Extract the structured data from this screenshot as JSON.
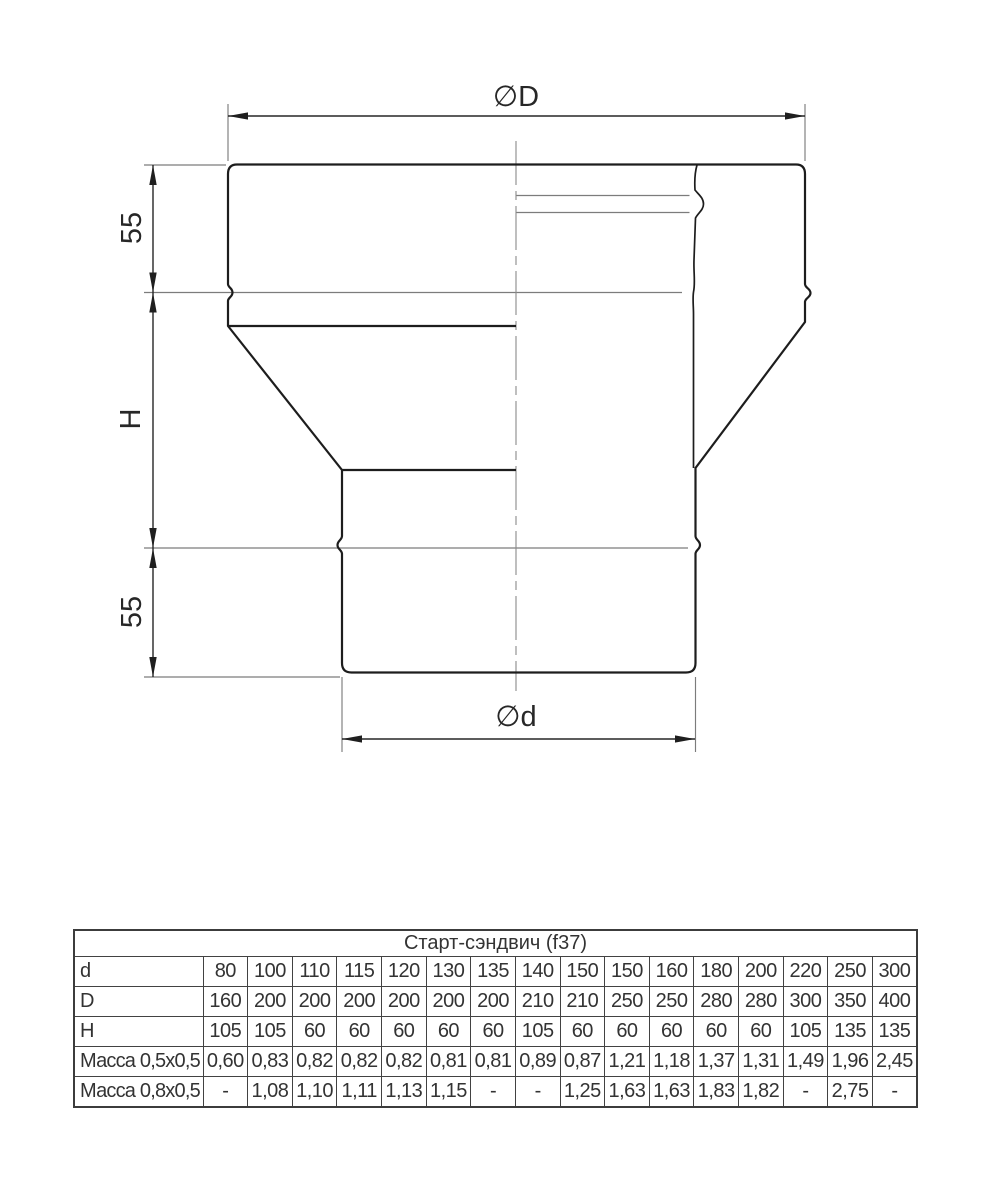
{
  "drawing": {
    "labels": {
      "diameter_top": "∅D",
      "diameter_bottom": "∅d",
      "height_top": "55",
      "height_middle": "H",
      "height_bottom": "55"
    }
  },
  "table": {
    "title": "Старт-сэндвич (f37)",
    "rows": [
      {
        "label": "d",
        "values": [
          "80",
          "100",
          "110",
          "115",
          "120",
          "130",
          "135",
          "140",
          "150",
          "150",
          "160",
          "180",
          "200",
          "220",
          "250",
          "300"
        ]
      },
      {
        "label": "D",
        "values": [
          "160",
          "200",
          "200",
          "200",
          "200",
          "200",
          "200",
          "210",
          "210",
          "250",
          "250",
          "280",
          "280",
          "300",
          "350",
          "400"
        ]
      },
      {
        "label": "H",
        "values": [
          "105",
          "105",
          "60",
          "60",
          "60",
          "60",
          "60",
          "105",
          "60",
          "60",
          "60",
          "60",
          "60",
          "105",
          "135",
          "135"
        ]
      },
      {
        "label": "Масса 0,5x0,5",
        "values": [
          "0,60",
          "0,83",
          "0,82",
          "0,82",
          "0,82",
          "0,81",
          "0,81",
          "0,89",
          "0,87",
          "1,21",
          "1,18",
          "1,37",
          "1,31",
          "1,49",
          "1,96",
          "2,45"
        ]
      },
      {
        "label": "Масса 0,8x0,5",
        "values": [
          "-",
          "1,08",
          "1,10",
          "1,11",
          "1,13",
          "1,15",
          "-",
          "-",
          "1,25",
          "1,63",
          "1,63",
          "1,83",
          "1,82",
          "-",
          "2,75",
          "-"
        ]
      }
    ]
  },
  "colors": {
    "background": "#ffffff",
    "contour": "#1d1d1d",
    "thin_line": "#7c7c7c",
    "dimension": "#262626",
    "text": "#333333",
    "table_border": "#3f3f3f"
  }
}
